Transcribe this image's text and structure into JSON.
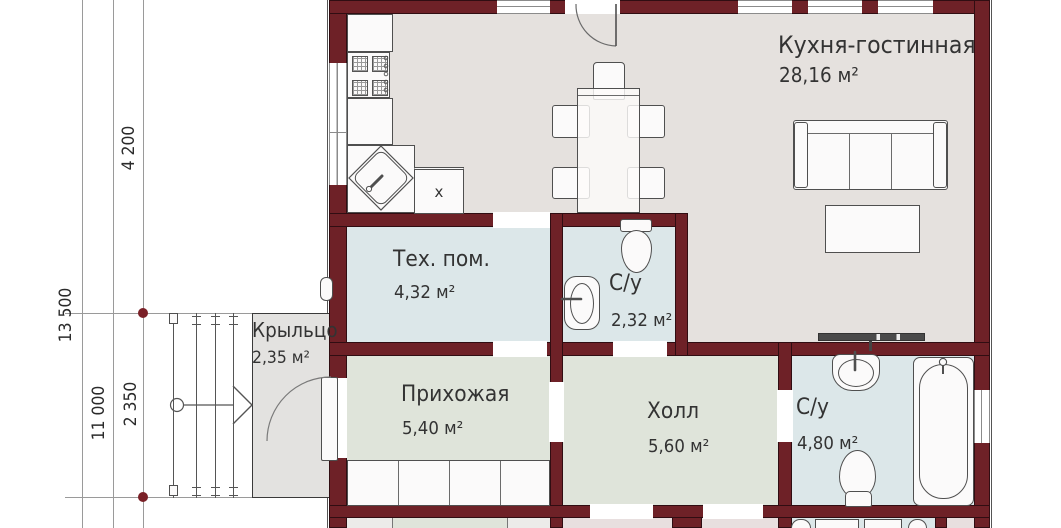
{
  "plan": {
    "rooms": {
      "kitchen_living": {
        "name": "Кухня-гостинная",
        "area": "28,16 м²"
      },
      "tech_room": {
        "name": "Тех. пом.",
        "area": "4,32 м²"
      },
      "wc_small": {
        "name": "С/у",
        "area": "2,32 м²"
      },
      "porch": {
        "name": "Крыльцо",
        "area": "2,35 м²"
      },
      "entry_hall": {
        "name": "Прихожая",
        "area": "5,40 м²"
      },
      "hall": {
        "name": "Холл",
        "area": "5,60 м²"
      },
      "wc_big": {
        "name": "С/у",
        "area": "4,80 м²"
      }
    },
    "dimensions": {
      "overall_depth": "13 500",
      "house_depth": "11 000",
      "kitchen_depth": "4 200",
      "porch_depth": "2 350"
    },
    "markers": {
      "dishwasher": "x"
    },
    "colors": {
      "wall": "#6e2127",
      "floor_living": "#e5e1de",
      "floor_wet": "#dce7e9",
      "floor_hall": "#dfe4da",
      "floor_porch": "#e3e2e0",
      "floor_neighbor": "#e8dfdf",
      "dimension_marker": "#7a2027"
    }
  }
}
